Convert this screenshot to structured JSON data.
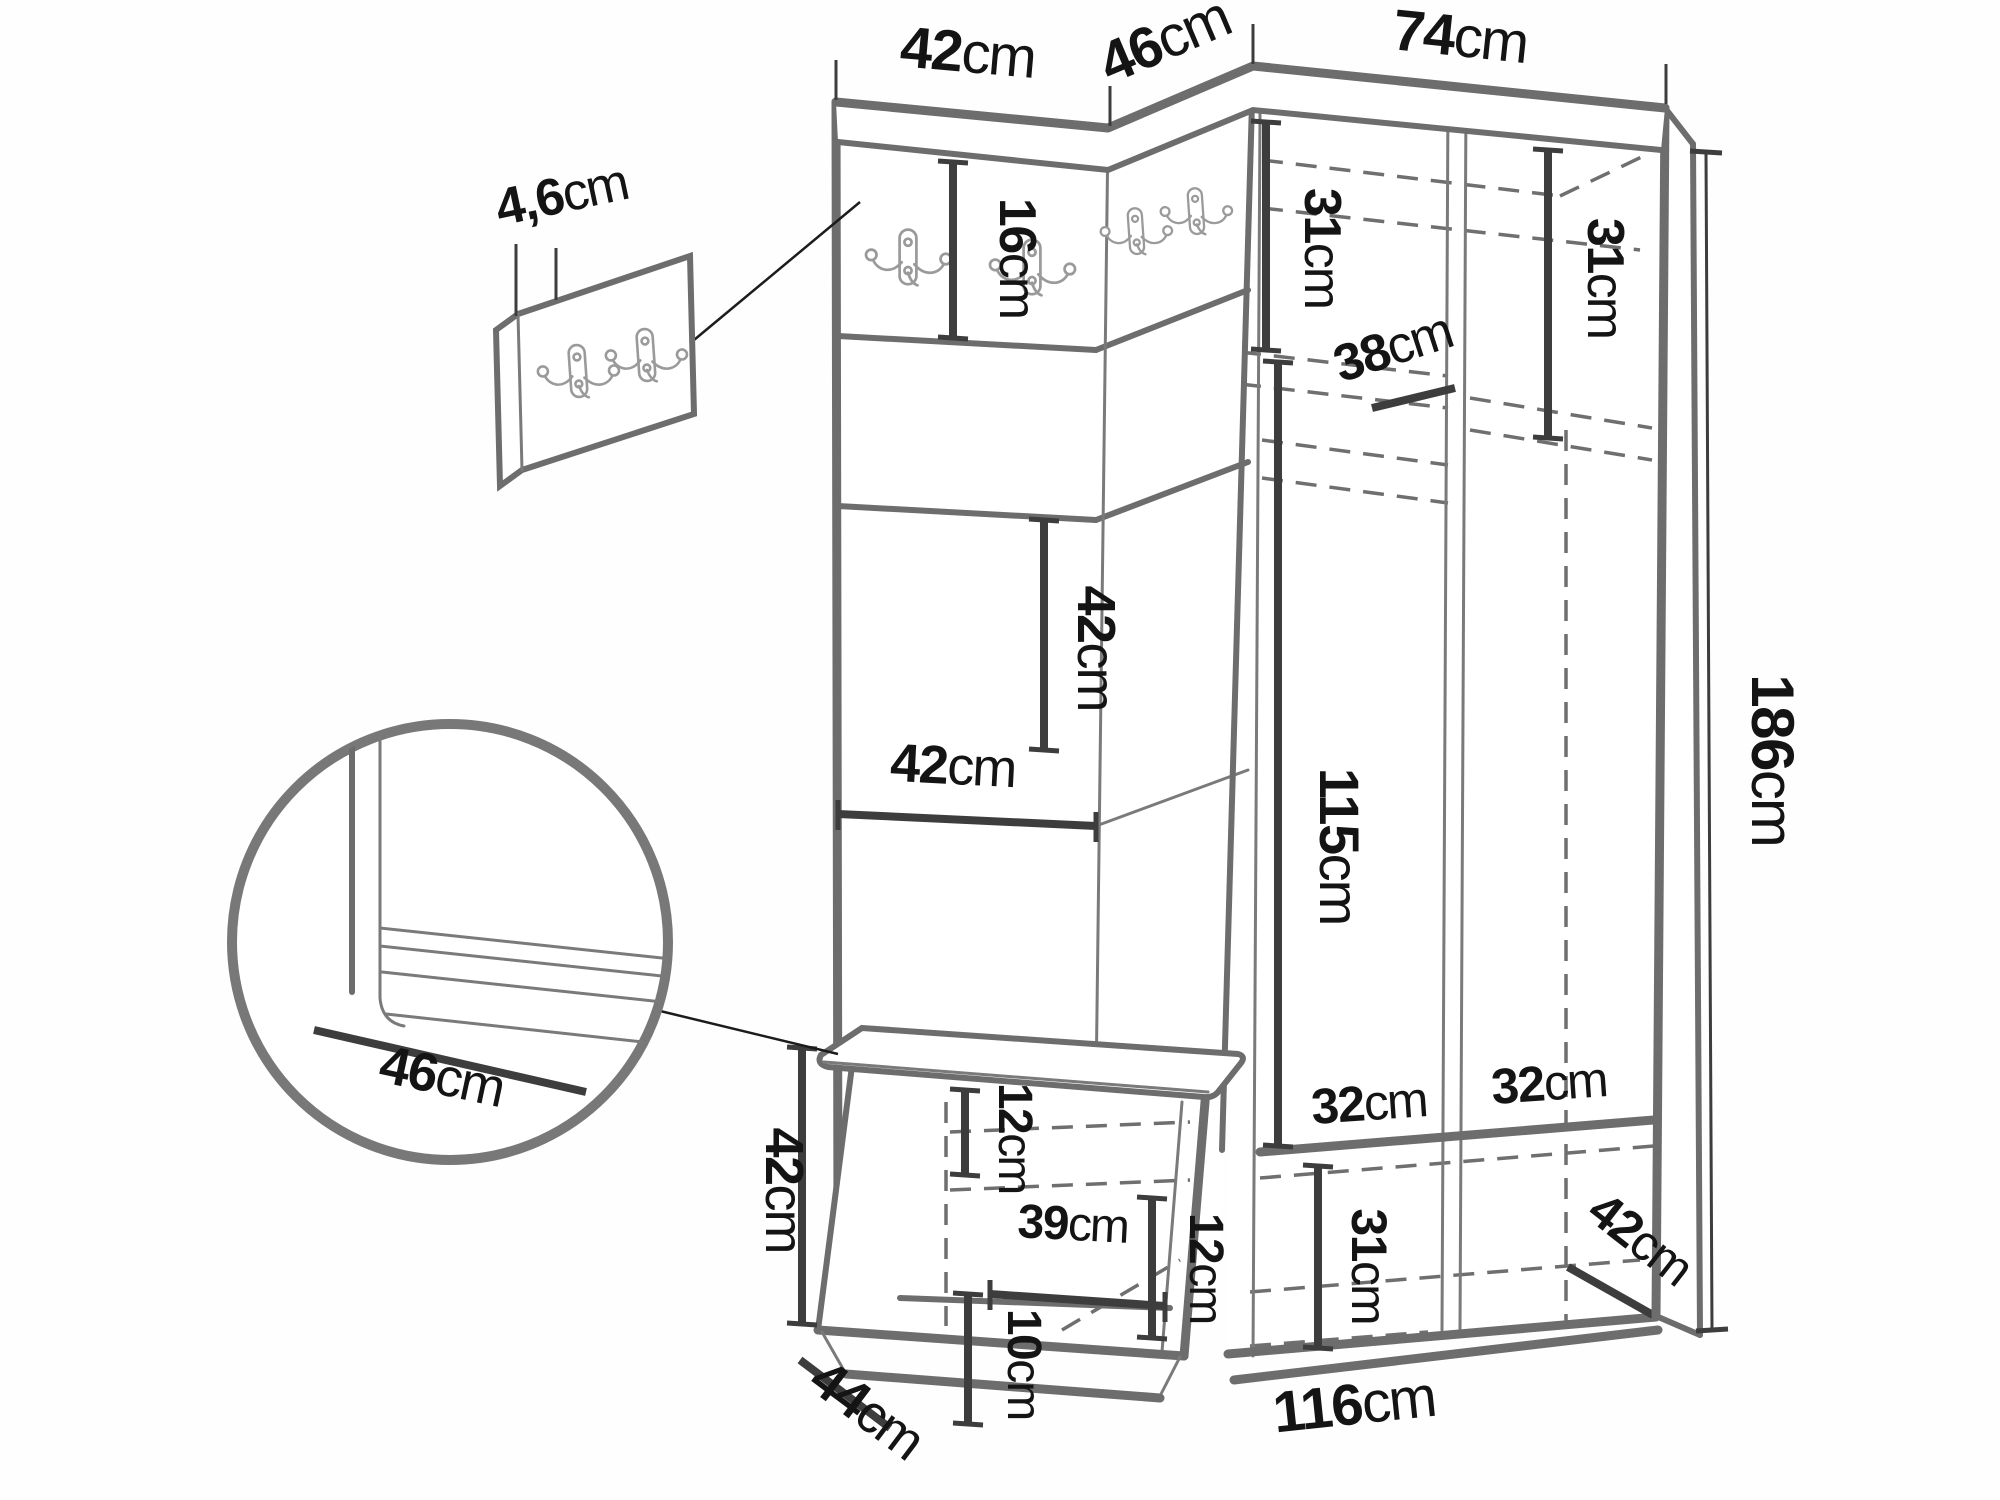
{
  "diagram": {
    "kind": "furniture-dimension-diagram",
    "units": "cm",
    "icons": {
      "coat_hook": "double-coat-hook-icon",
      "detail_circle": "magnified-detail-circle"
    },
    "dims": {
      "panel_width_top": {
        "value": "42",
        "unit": "cm"
      },
      "corner_width_top": {
        "value": "46",
        "unit": "cm"
      },
      "wardrobe_width_top": {
        "value": "74",
        "unit": "cm"
      },
      "hook_strip_height": {
        "value": "16",
        "unit": "cm"
      },
      "top_shelf_left_height": {
        "value": "31",
        "unit": "cm"
      },
      "top_shelf_right_height": {
        "value": "31",
        "unit": "cm"
      },
      "rail_depth": {
        "value": "38",
        "unit": "cm"
      },
      "panel_square_height": {
        "value": "42",
        "unit": "cm"
      },
      "panel_square_width": {
        "value": "42",
        "unit": "cm"
      },
      "hanging_space_height": {
        "value": "115",
        "unit": "cm"
      },
      "total_height": {
        "value": "186",
        "unit": "cm"
      },
      "hook_panel_thickness": {
        "value": "4,6",
        "unit": "cm"
      },
      "seat_depth_detail": {
        "value": "46",
        "unit": "cm"
      },
      "bench_height": {
        "value": "42",
        "unit": "cm"
      },
      "bench_top_clearance": {
        "value": "12",
        "unit": "cm"
      },
      "bench_inner_width": {
        "value": "39",
        "unit": "cm"
      },
      "bench_right_clearance": {
        "value": "12",
        "unit": "cm"
      },
      "bench_bottom_clearance": {
        "value": "10",
        "unit": "cm"
      },
      "bench_depth": {
        "value": "44",
        "unit": "cm"
      },
      "shoe_shelf_left_width": {
        "value": "32",
        "unit": "cm"
      },
      "shoe_shelf_right_width": {
        "value": "32",
        "unit": "cm"
      },
      "shoe_compartment_height": {
        "value": "31",
        "unit": "cm"
      },
      "wardrobe_depth": {
        "value": "42",
        "unit": "cm"
      },
      "base_width": {
        "value": "116",
        "unit": "cm"
      }
    }
  }
}
